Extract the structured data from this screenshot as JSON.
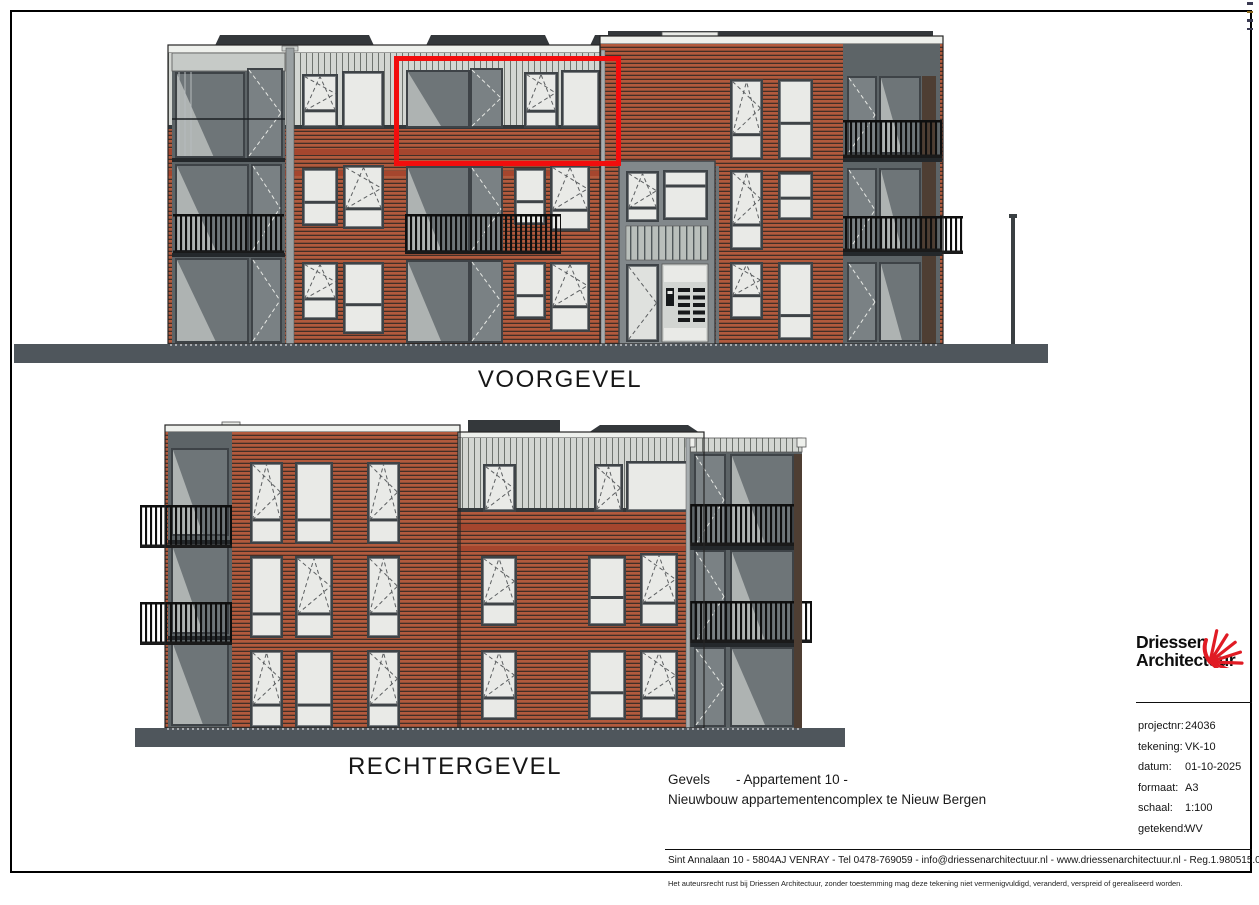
{
  "sheet": {
    "elevations": {
      "front": {
        "label": "VOORGEVEL"
      },
      "right": {
        "label": "RECHTERGEVEL"
      }
    },
    "highlight_meaning": "Appartement 10"
  },
  "drawing_info": {
    "type": "Gevels",
    "apartment": "- Appartement 10 -",
    "project": "Nieuwbouw appartementencomplex te Nieuw Bergen"
  },
  "title_block": {
    "logo_line1": "Driessen",
    "logo_line2": "Architectuur",
    "fields": [
      {
        "label": "projectnr:",
        "value": "24036"
      },
      {
        "label": "tekening:",
        "value": "VK-10"
      },
      {
        "label": "datum:",
        "value": "01-10-2025"
      },
      {
        "label": "formaat:",
        "value": "A3"
      },
      {
        "label": "schaal:",
        "value": "1:100"
      },
      {
        "label": "getekend:",
        "value": "WV"
      }
    ]
  },
  "footer": {
    "address": "Sint Annalaan 10 - 5804AJ VENRAY - Tel 0478-769059 - info@driessenarchitectuur.nl - www.driessenarchitectuur.nl - Reg.1.980515.016",
    "copyright": "Het auteursrecht rust bij Driessen Architectuur, zonder toestemming mag deze tekening niet vermenigvuldigd, veranderd, verspreid of gerealiseerd worden."
  },
  "colors": {
    "highlight_red": "#f20d0d",
    "logo_red": "#e01b24",
    "brick": "#b25a3d",
    "brick_joint": "#432f27",
    "brick_band": "#a5462e",
    "siding": "#d3d6d2",
    "siding_line": "#6f746f",
    "window_frame": "#3e4347",
    "glass_light": "#e9eae7",
    "glass_dark": "#6e7578",
    "door_dark": "#7a8184",
    "railing": "#0f0f0f",
    "ground": "#4f565c",
    "roof": "#34383b",
    "coping": "#eef0ec",
    "recess_backdrop": "#5d6467"
  }
}
